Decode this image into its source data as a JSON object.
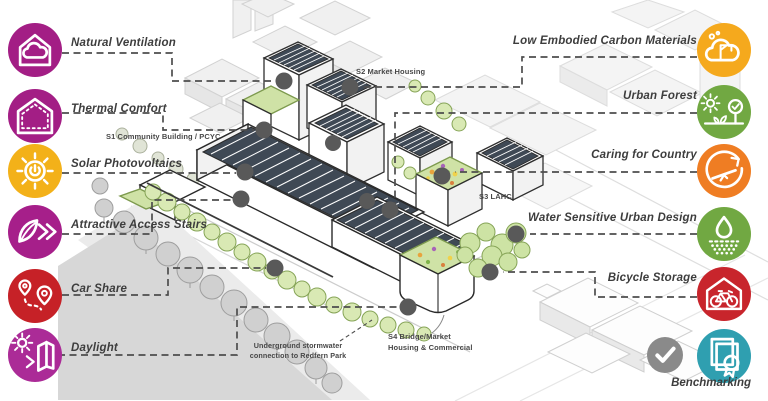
{
  "figure": {
    "type": "sustainability-site-diagram",
    "description": "Isometric masterplan sketch with sustainability features"
  },
  "left_features": [
    {
      "label": "Natural Ventilation",
      "icon": "house-cloud-icon",
      "color": "#A31E85"
    },
    {
      "label": "Thermal Comfort",
      "icon": "insulated-house-icon",
      "color": "#A31E85"
    },
    {
      "label": "Solar Photovoltaics",
      "icon": "sun-power-icon",
      "color": "#F3B119"
    },
    {
      "label": "Attractive Access Stairs",
      "icon": "leaf-chevrons-icon",
      "color": "#A61F8A"
    },
    {
      "label": "Car Share",
      "icon": "map-pins-route-icon",
      "color": "#C62127"
    },
    {
      "label": "Daylight",
      "icon": "sun-building-icon",
      "color": "#AB2B97"
    }
  ],
  "right_features": [
    {
      "label": "Low Embodied Carbon Materials",
      "icon": "cloud-crane-icon",
      "color": "#F5A91D"
    },
    {
      "label": "Urban Forest",
      "icon": "sun-tree-icon",
      "color": "#71A842"
    },
    {
      "label": "Caring for Country",
      "icon": "cycle-balance-icon",
      "color": "#EF7D23"
    },
    {
      "label": "Water Sensitive Urban Design",
      "icon": "droplet-infiltration-icon",
      "color": "#71A842"
    },
    {
      "label": "Bicycle Storage",
      "icon": "bicycle-shed-icon",
      "color": "#C8252C"
    },
    {
      "label": "Benchmarking",
      "icon": "certificate-icon",
      "color": "#2F9FB0"
    }
  ],
  "status": {
    "check_icon": "checkmark-icon",
    "check_color": "#8A8A8A"
  },
  "site_labels": {
    "s1": "S1 Community Building / PCYC",
    "s2": "S2 Market Housing",
    "s3": "S3 LAHC",
    "s4_line1": "S4 Bridge/Market",
    "s4_line2": "Housing & Commercial",
    "stormwater_line1": "Underground stormwater",
    "stormwater_line2": "connection to Redfern Park"
  }
}
